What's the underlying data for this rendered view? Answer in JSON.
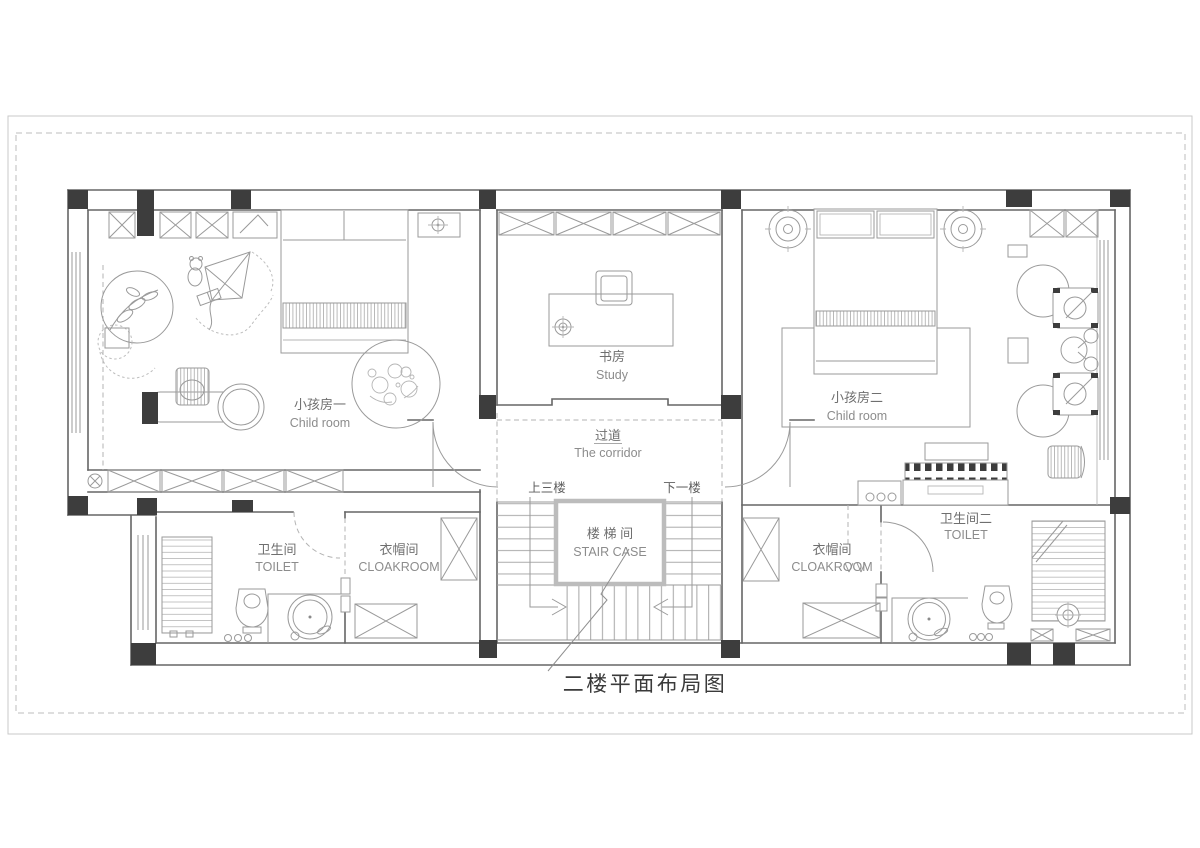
{
  "title": "二楼平面布局图",
  "rooms": {
    "child1": {
      "cn": "小孩房一",
      "en": "Child room"
    },
    "study": {
      "cn": "书房",
      "en": "Study"
    },
    "child2": {
      "cn": "小孩房二",
      "en": "Child room"
    },
    "corridor": {
      "cn": "过道",
      "en": "The corridor"
    },
    "staircase": {
      "cn": "楼 梯 间",
      "en": "STAIR CASE"
    },
    "toilet_left": {
      "cn": "卫生间",
      "en": "TOILET"
    },
    "cloakroom_left": {
      "cn": "衣帽间",
      "en": "CLOAKROOM"
    },
    "cloakroom_right": {
      "cn": "衣帽间",
      "en": "CLOAKROOM"
    },
    "toilet_right": {
      "cn": "卫生间二",
      "en": "TOILET"
    }
  },
  "stairs": {
    "up": "上三楼",
    "down": "下一楼"
  },
  "colors": {
    "wall": "#666666",
    "furniture": "#9a9a9a",
    "column": "#3d3d3d",
    "text": "#6f6f6f",
    "texten": "#8c8c8c",
    "frame": "#c9c9c9",
    "titlecolor": "#3a3a3a"
  }
}
